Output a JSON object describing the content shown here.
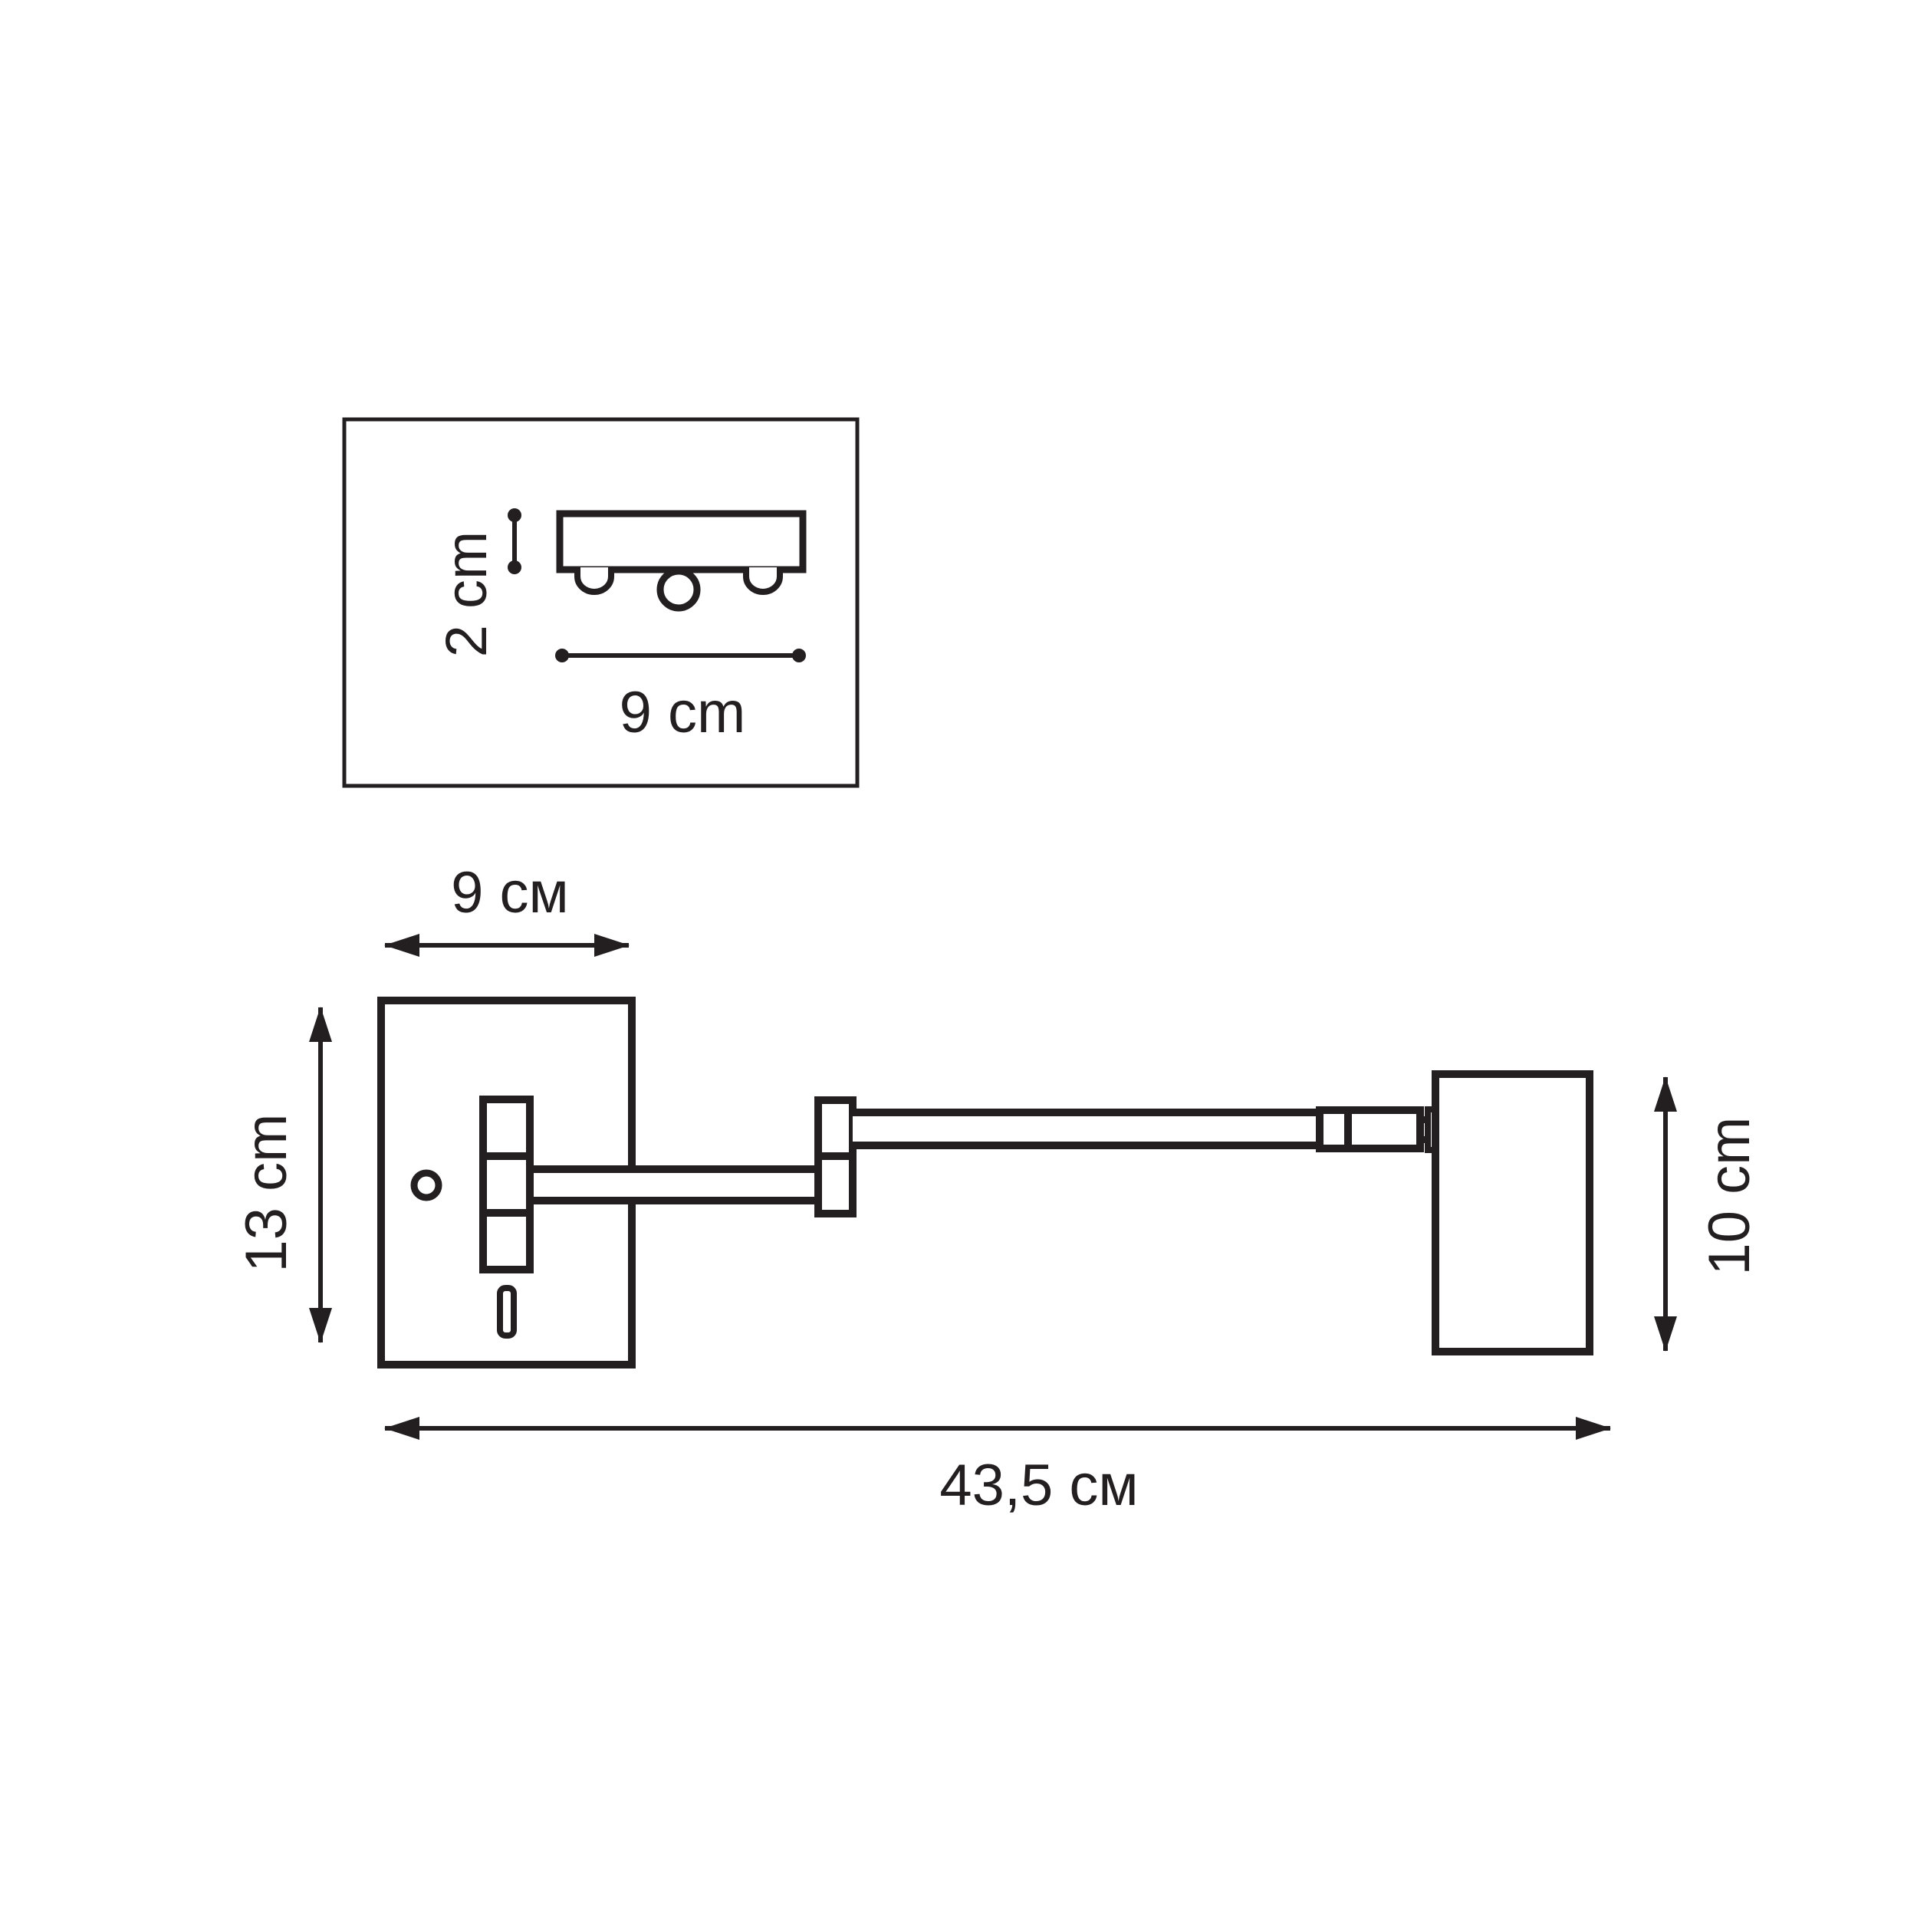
{
  "meta": {
    "background_color": "#ffffff",
    "line_color": "#231f20",
    "drawing_type": "wall lamp dimension diagram"
  },
  "inset": {
    "height_label": "2 cm",
    "width_label": "9 cm"
  },
  "main": {
    "plate_width_label": "9 см",
    "plate_height_label": "13 cm",
    "head_height_label": "10 cm",
    "total_length_label": "43,5 см"
  }
}
